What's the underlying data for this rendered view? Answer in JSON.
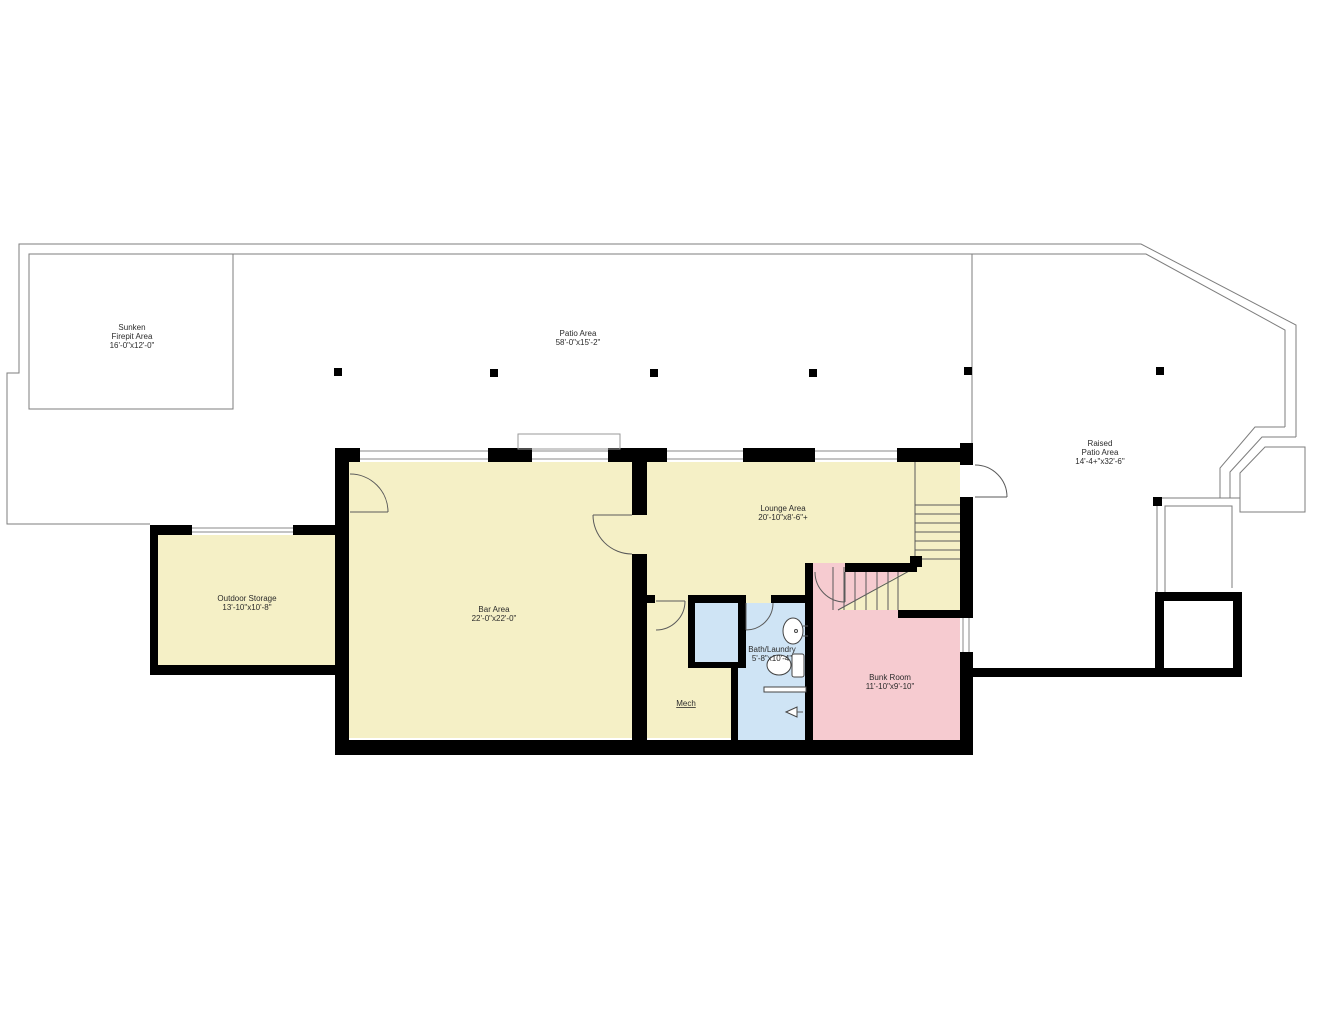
{
  "colors": {
    "wall": "#000000",
    "outline_gray": "#7d7d7d",
    "room_yellow": "#f5f0c6",
    "room_pink": "#f6cbd0",
    "room_blue": "#cfe4f5",
    "text": "#2b2b2b"
  },
  "areas": {
    "sunken_firepit": {
      "line1": "Sunken",
      "line2": "Firepit Area",
      "dims": "16'-0\"x12'-0\""
    },
    "patio": {
      "name": "Patio Area",
      "dims": "58'-0\"x15'-2\""
    },
    "raised_patio": {
      "line1": "Raised",
      "line2": "Patio Area",
      "dims": "14'-4+\"x32'-6\""
    },
    "outdoor_storage": {
      "name": "Outdoor Storage",
      "dims": "13'-10\"x10'-8\""
    },
    "bar": {
      "name": "Bar Area",
      "dims": "22'-0\"x22'-0\""
    },
    "lounge": {
      "name": "Lounge Area",
      "dims": "20'-10\"x8'-6\"+"
    },
    "bath_laundry": {
      "name": "Bath/Laundry",
      "dims": "5'-8\"x10'-4\""
    },
    "bunk": {
      "name": "Bunk Room",
      "dims": "11'-10\"x9'-10\""
    },
    "mech": {
      "name": "Mech"
    }
  }
}
